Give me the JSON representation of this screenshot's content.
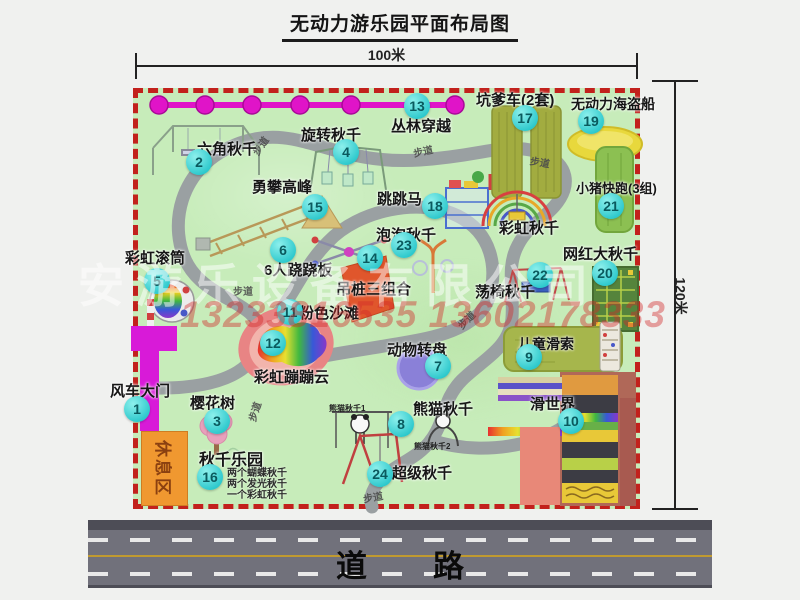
{
  "title": "无动力游乐园平面布局图",
  "dimension": {
    "width": "100米",
    "height": "120米"
  },
  "watermark": {
    "company": "安游乐设备有限公司",
    "phones": "13233816535 13602178333"
  },
  "road": {
    "label": "道路"
  },
  "colors": {
    "park_green": "#c7ecba",
    "border_red": "#c2211c",
    "badge_cyan": "#2cc8cc",
    "zipline_magenta": "#e014c8",
    "gate_magenta": "#d81ad8",
    "rest_area_orange": "#f09830",
    "road_gray": "#71717b",
    "lane_yellow": "#c09a30"
  },
  "park": {
    "rest_area": "休息区",
    "walkway_label": "步道",
    "rainbow_swing_label": "彩虹秋千",
    "attractions": [
      {
        "num": "1",
        "name": "风车大门",
        "bx": 124,
        "by": 396,
        "lx": 110,
        "ly": 380
      },
      {
        "num": "2",
        "name": "六角秋千",
        "bx": 186,
        "by": 149,
        "lx": 197,
        "ly": 138
      },
      {
        "num": "3",
        "name": "樱花树",
        "bx": 204,
        "by": 408,
        "lx": 190,
        "ly": 392
      },
      {
        "num": "4",
        "name": "旋转秋千",
        "bx": 333,
        "by": 139,
        "lx": 301,
        "ly": 124
      },
      {
        "num": "5",
        "name": "彩虹滚筒",
        "bx": 144,
        "by": 268,
        "lx": 125,
        "ly": 247
      },
      {
        "num": "6",
        "name": "6人跷跷板",
        "bx": 270,
        "by": 237,
        "lx": 264,
        "ly": 259
      },
      {
        "num": "7",
        "name": "动物转盘",
        "bx": 425,
        "by": 353,
        "lx": 387,
        "ly": 339
      },
      {
        "num": "8",
        "name": "熊猫秋千",
        "bx": 388,
        "by": 411,
        "lx": 413,
        "ly": 398
      },
      {
        "num": "9",
        "name": "儿童滑索",
        "bx": 516,
        "by": 344,
        "lx": 518,
        "ly": 334,
        "fs": 14
      },
      {
        "num": "10",
        "name": "滑世界",
        "bx": 558,
        "by": 408,
        "lx": 530,
        "ly": 393
      },
      {
        "num": "11",
        "name": "粉色沙滩",
        "bx": 277,
        "by": 299,
        "lx": 299,
        "ly": 302
      },
      {
        "num": "12",
        "name": "彩虹蹦蹦云",
        "bx": 260,
        "by": 330,
        "lx": 254,
        "ly": 366
      },
      {
        "num": "13",
        "name": "丛林穿越",
        "bx": 404,
        "by": 93,
        "lx": 391,
        "ly": 115
      },
      {
        "num": "14",
        "name": "吊桩三组合",
        "bx": 357,
        "by": 245,
        "lx": 336,
        "ly": 278
      },
      {
        "num": "15",
        "name": "勇攀高峰",
        "bx": 302,
        "by": 194,
        "lx": 252,
        "ly": 176
      },
      {
        "num": "16",
        "name": "秋千乐园",
        "bx": 197,
        "by": 464,
        "lx": 199,
        "ly": 446,
        "fs": 16
      },
      {
        "num": "17",
        "name": "坑爹车(2套)",
        "bx": 512,
        "by": 105,
        "lx": 476,
        "ly": 89
      },
      {
        "num": "18",
        "name": "跳跳马",
        "bx": 422,
        "by": 193,
        "lx": 377,
        "ly": 188
      },
      {
        "num": "19",
        "name": "无动力海盗船",
        "bx": 578,
        "by": 108,
        "lx": 571,
        "ly": 94,
        "fs": 14
      },
      {
        "num": "20",
        "name": "网红大秋千",
        "bx": 592,
        "by": 260,
        "lx": 563,
        "ly": 243
      },
      {
        "num": "21",
        "name": "小猪快跑(3组)",
        "bx": 598,
        "by": 193,
        "lx": 576,
        "ly": 178,
        "fs": 13
      },
      {
        "num": "22",
        "name": "荡椅秋千",
        "bx": 527,
        "by": 262,
        "lx": 475,
        "ly": 281
      },
      {
        "num": "23",
        "name": "泡泡秋千",
        "bx": 391,
        "by": 232,
        "lx": 376,
        "ly": 224
      },
      {
        "num": "24",
        "name": "超级秋千",
        "bx": 367,
        "by": 461,
        "lx": 392,
        "ly": 462
      }
    ],
    "walkway_labels": [
      {
        "x": 250,
        "y": 138,
        "r": -55
      },
      {
        "x": 413,
        "y": 143,
        "r": -12
      },
      {
        "x": 530,
        "y": 154,
        "r": 10
      },
      {
        "x": 233,
        "y": 283,
        "r": 0
      },
      {
        "x": 244,
        "y": 404,
        "r": -72
      },
      {
        "x": 363,
        "y": 489,
        "r": -10
      },
      {
        "x": 456,
        "y": 312,
        "r": -45
      }
    ],
    "swing_park_details": [
      "两个蝴蝶秋千",
      "两个发光秋千",
      "一个彩虹秋千"
    ],
    "panda_sub_labels": [
      {
        "text": "熊猫秋千1",
        "x": 329,
        "y": 403
      },
      {
        "text": "熊猫秋千2",
        "x": 414,
        "y": 441
      }
    ]
  }
}
